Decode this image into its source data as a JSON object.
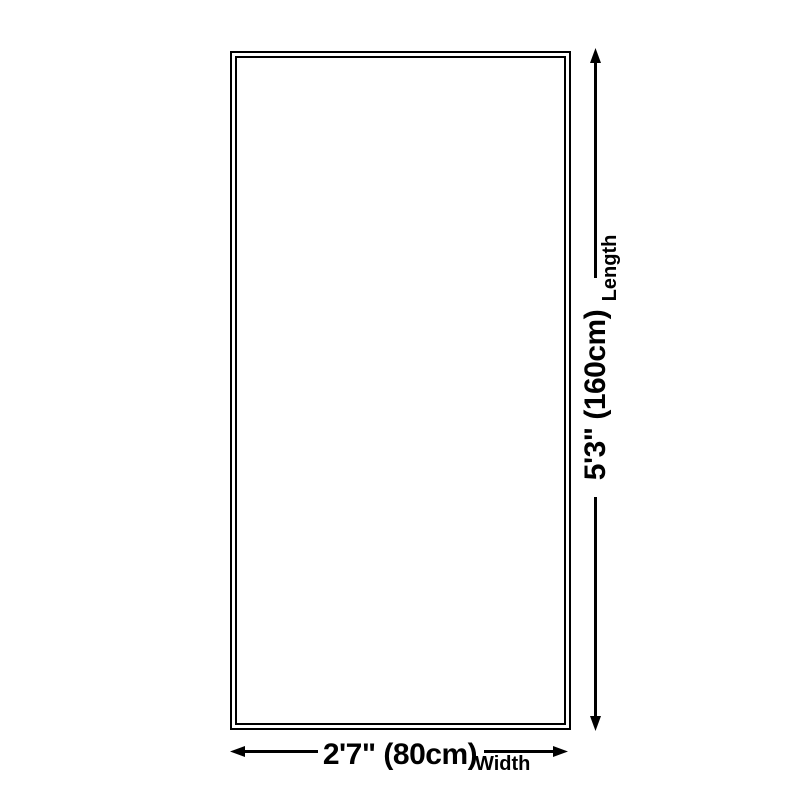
{
  "page": {
    "background_color": "#ffffff"
  },
  "diagram": {
    "type": "product-dimensions",
    "shape": "rectangle",
    "line_color": "#000000",
    "rug": {
      "border_color": "#000000",
      "fill_color": "#ffffff",
      "border_style": "double"
    },
    "length": {
      "value": "5'3\" (160cm)",
      "axis_label": "Length"
    },
    "width": {
      "value": "2'7\" (80cm)",
      "axis_label": "Width"
    }
  }
}
